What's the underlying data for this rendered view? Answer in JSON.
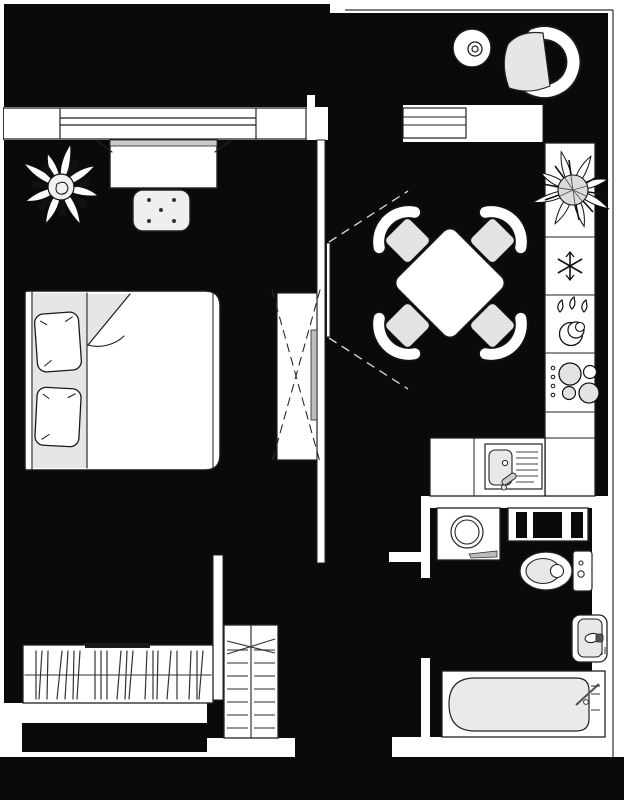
{
  "canvas": {
    "width": 624,
    "height": 800
  },
  "palette": {
    "background": "#ffffff",
    "floor_fill": "#0a0a0a",
    "wall_fill": "#ffffff",
    "outline": "#1a1a1a",
    "soft_gray": "#e6e6e6",
    "hatch_gray": "#555555"
  },
  "floorplan": {
    "type": "apartment-floor-plan-top-view",
    "rooms": [
      {
        "name": "bedroom",
        "fixtures": [
          "window",
          "potted-plant",
          "desk",
          "stool",
          "double-bed",
          "pillows",
          "sliding-wardrobe",
          "clothes-closet"
        ]
      },
      {
        "name": "balcony",
        "fixtures": [
          "round-side-table",
          "armchair"
        ]
      },
      {
        "name": "kitchen-living",
        "fixtures": [
          "balcony-window",
          "balcony-door-opening",
          "dining-table",
          "four-chairs",
          "potted-plant",
          "tall-cabinet-column",
          "refrigerator",
          "dishwasher",
          "cooktop",
          "kitchen-sink",
          "counter",
          "sliding-door"
        ]
      },
      {
        "name": "hallway",
        "fixtures": [
          "shelving-unit",
          "entry-niche"
        ]
      },
      {
        "name": "bathroom",
        "fixtures": [
          "washing-machine",
          "storage-cabinet",
          "toilet",
          "washbasin",
          "bathtub"
        ]
      }
    ],
    "icons": [
      {
        "name": "snowflake-icon",
        "meaning": "refrigerator"
      },
      {
        "name": "water-drops-plates-icon",
        "meaning": "dishwasher"
      },
      {
        "name": "burner-rings-icon",
        "meaning": "cooktop"
      }
    ]
  }
}
